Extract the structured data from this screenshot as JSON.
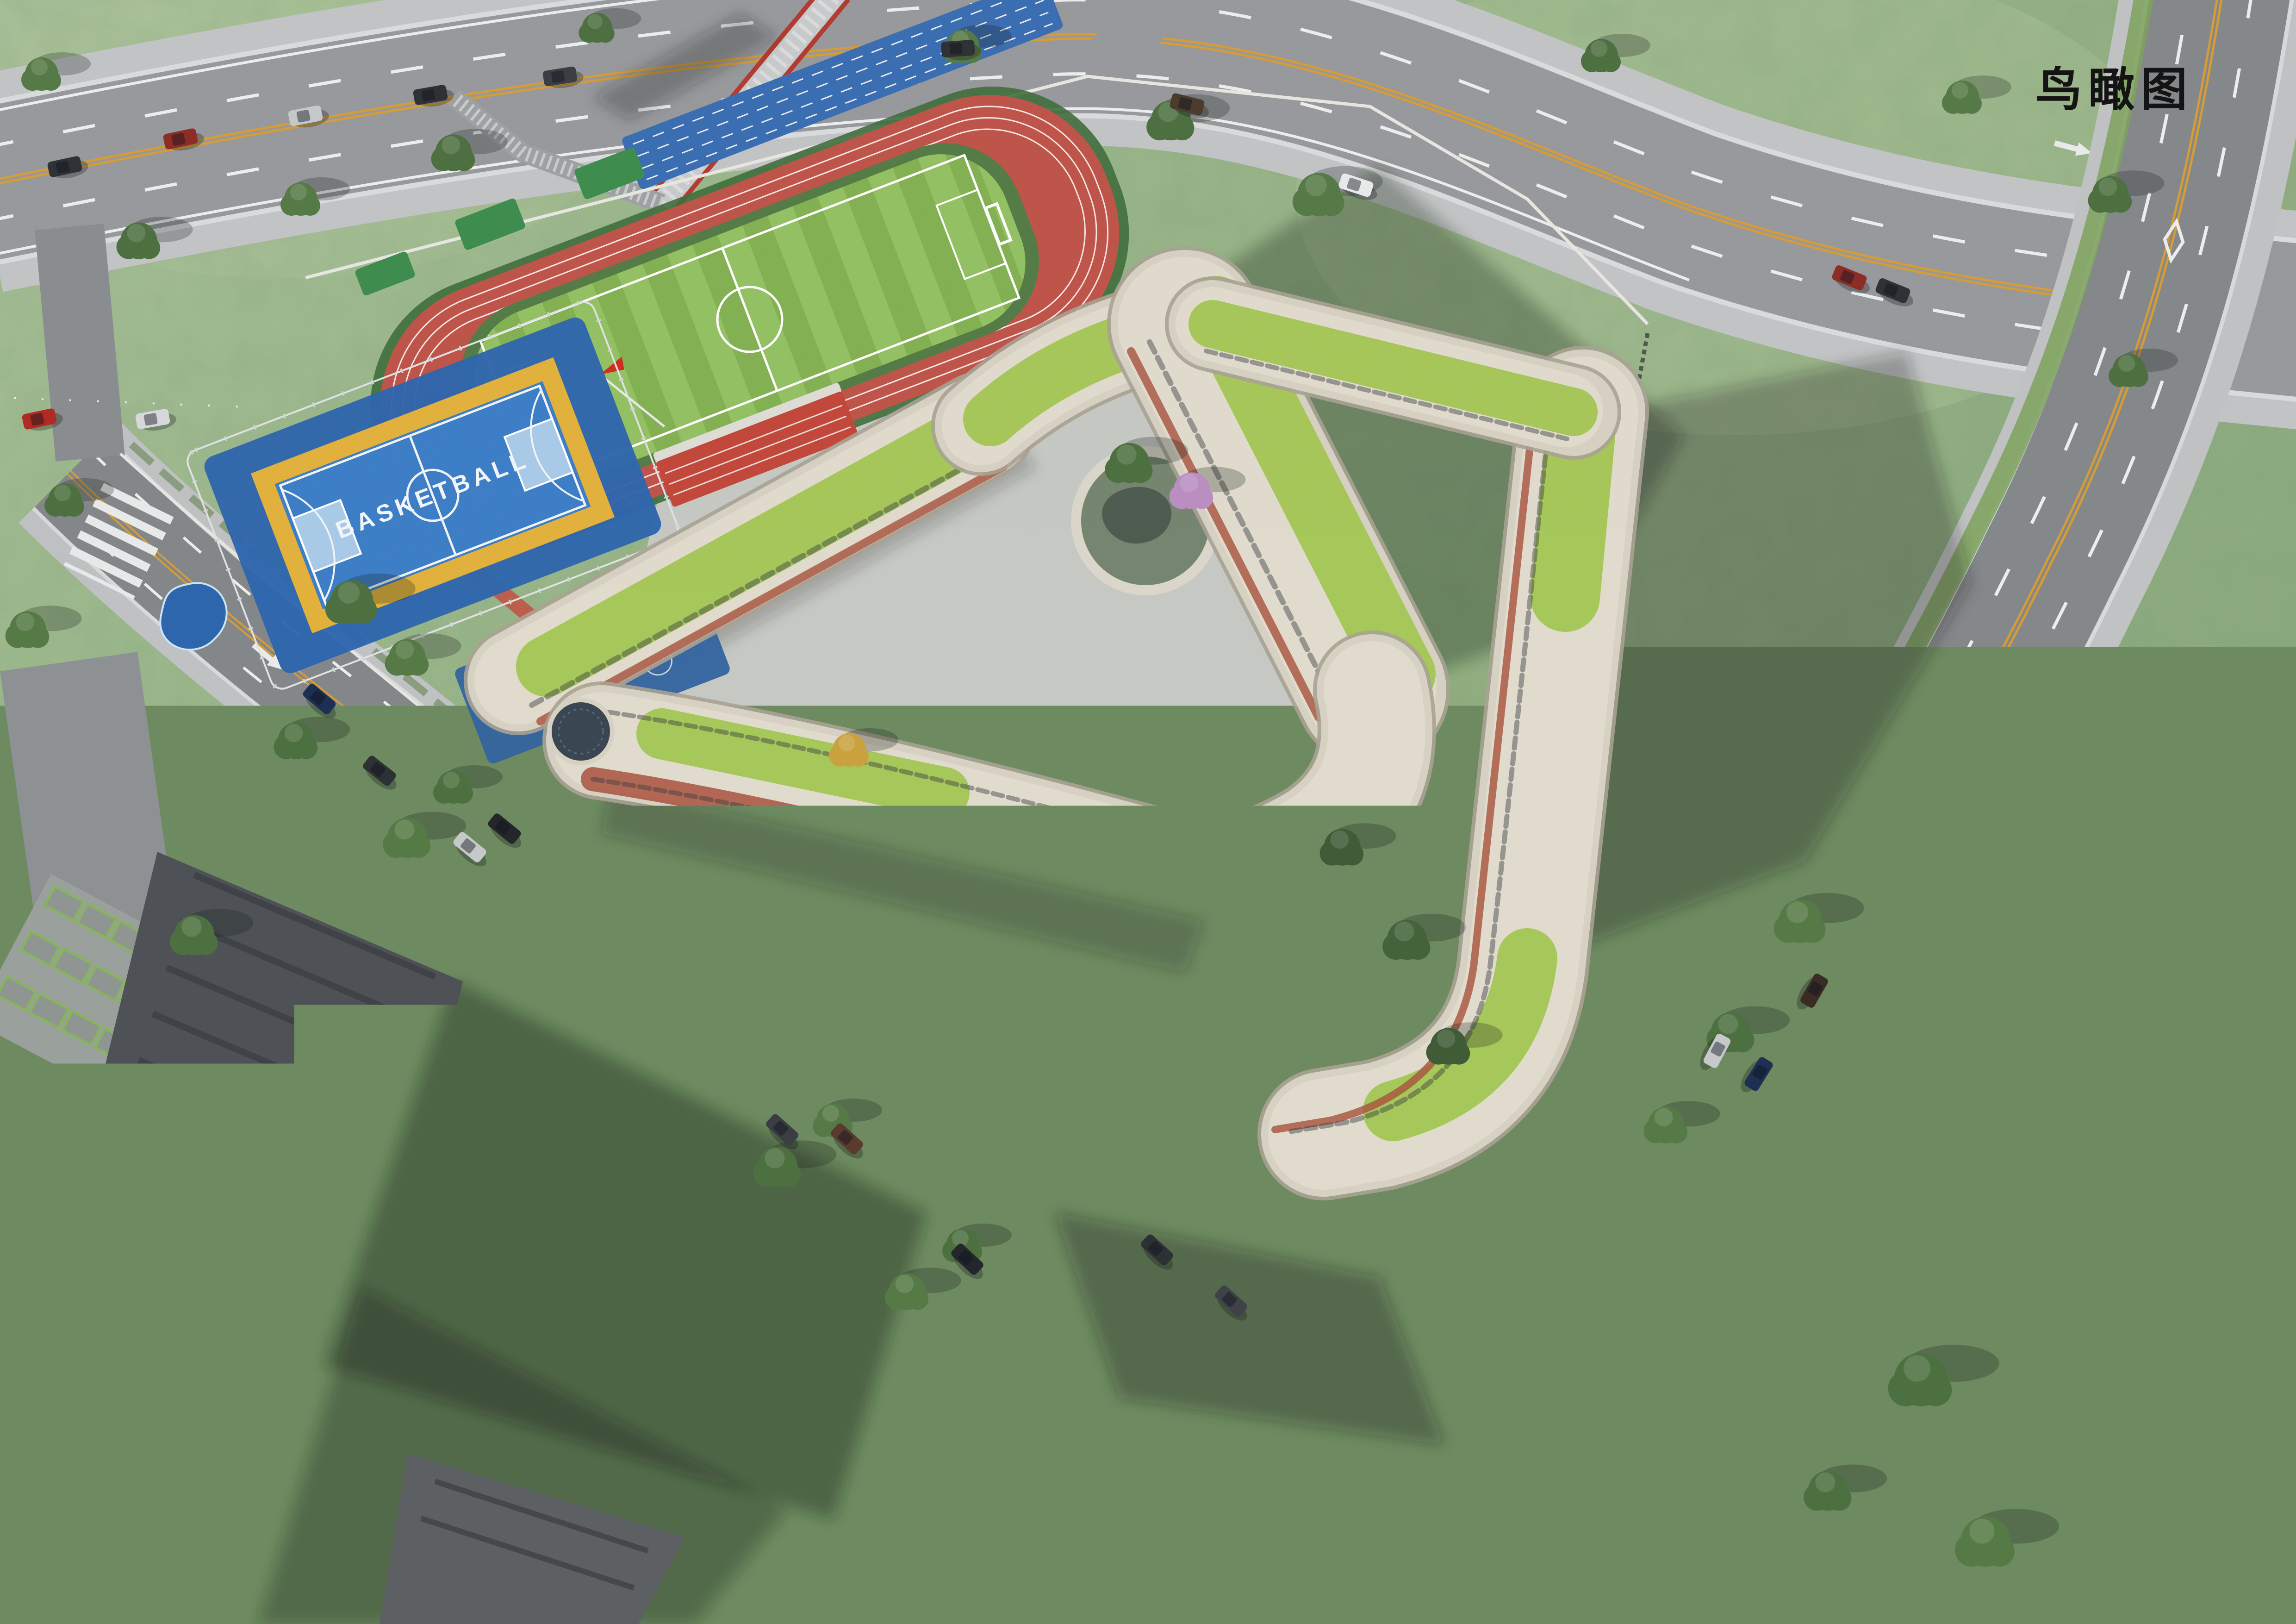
{
  "page": {
    "title": "鸟瞰图"
  },
  "labels": {
    "view_tag": "鸟瞰图",
    "basketball_court": "BASKETBALL"
  },
  "colors": {
    "grass": "#9ab884",
    "grass_light": "#b4c99e",
    "grass_dark": "#7fa06f",
    "road": "#97999c",
    "road_side": "#85888b",
    "intersection": "#74777a",
    "sidewalk": "#c2c4c5",
    "curb_white": "#d9dbdc",
    "lane_white": "#eceeee",
    "lane_yellow": "#d79c34",
    "track_red": "#bf5449",
    "field_green": "#93c163",
    "field_green_alt": "#83b152",
    "court_blue": "#3c7ec7",
    "court_platform_blue": "#2e66ad",
    "court_key_blue": "#a9cbe8",
    "court_border_yellow": "#e2b13c",
    "play_area_blue": "#34649f",
    "building_cream": "#d7d1c3",
    "building_slat": "#ece6d8",
    "roof_green": "#a6c75a",
    "brick_red": "#a8523d",
    "accent_red": "#c0392b",
    "flag_red": "#d22c1f",
    "grandstand_red": "#c2473a",
    "bleacher_green": "#3e8c4e",
    "tree_green": "#4d7040",
    "tree_green_alt": "#567a46",
    "blossom_pink": "#bb8ec2",
    "autumn_yellow": "#c9a23f",
    "tile_roof": "#a8512f",
    "tower_gray": "#4e5256",
    "plaza_gray": "#c7c9cb",
    "shadow": "#1e2620"
  }
}
